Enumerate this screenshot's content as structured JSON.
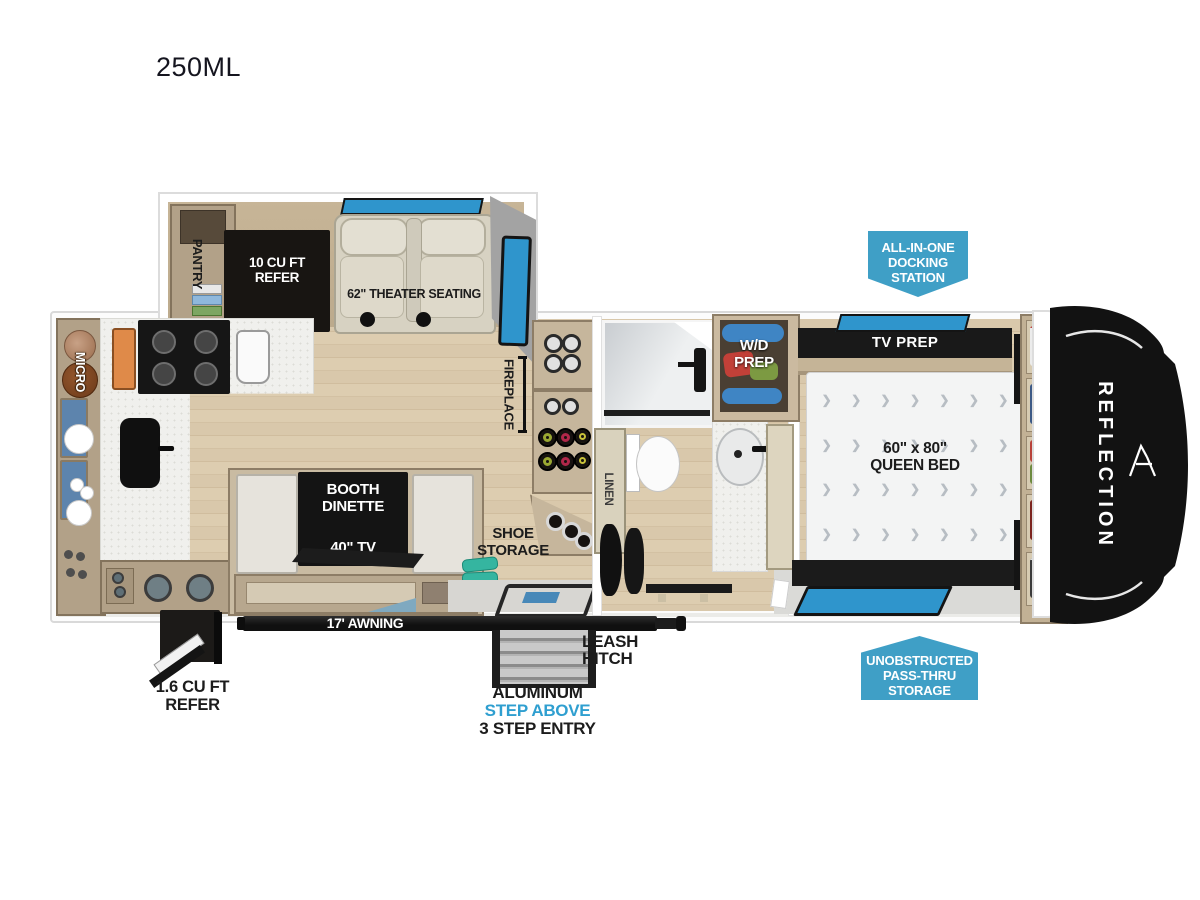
{
  "title": "250ML",
  "brand": "REFLECTION",
  "colors": {
    "badge_blue": "#3f9fc6",
    "window_blue": "#2f95cc",
    "step_above_blue": "#2f9fd0"
  },
  "slideout": {
    "pantry": "PANTRY",
    "refer": "10 CU FT\nREFER",
    "theater": "62\" THEATER SEATING"
  },
  "kitchen": {
    "micro": "MICRO"
  },
  "living": {
    "fireplace": "FIREPLACE",
    "dinette": "BOOTH\nDINETTE",
    "dinette_tv": "40\" TV",
    "shoe_storage": "SHOE\nSTORAGE"
  },
  "bath": {
    "linen": "LINEN",
    "wd_prep": "W/D\nPREP"
  },
  "bedroom": {
    "tv_prep": "TV PREP",
    "bed": "60\" x 80\"\nQUEEN BED"
  },
  "callouts": {
    "docking": "ALL-IN-ONE\nDOCKING\nSTATION",
    "passthru": "UNOBSTRUCTED\nPASS-THRU\nSTORAGE"
  },
  "exterior": {
    "awning": "17' AWNING",
    "leash_hitch": "LEASH\nHITCH",
    "step_line1": "ALUMINUM",
    "step_line2": "STEP ABOVE",
    "step_line3": "3 STEP ENTRY",
    "mini_refer": "1.6 CU FT\nREFER"
  }
}
